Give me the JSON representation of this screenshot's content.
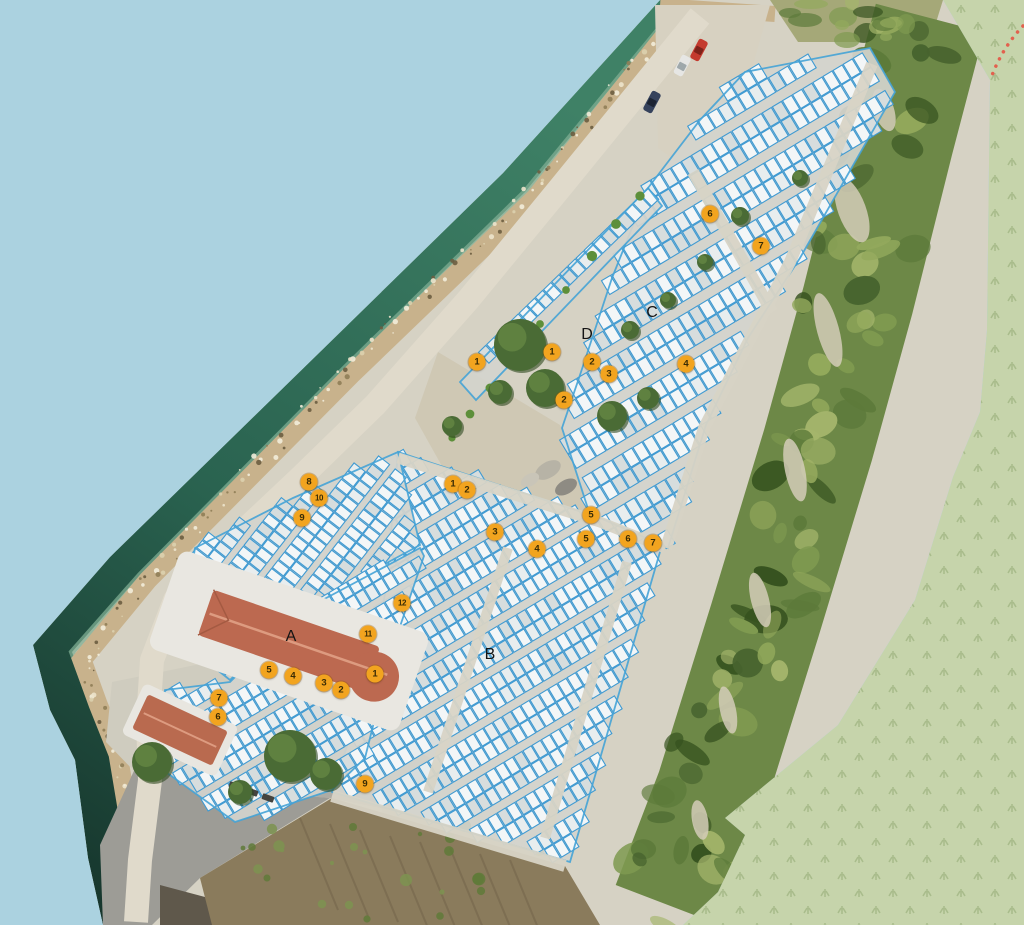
{
  "map": {
    "description": "aerial-orthophoto-berth-map",
    "zone_letters_visible": [
      "A",
      "B",
      "C",
      "D"
    ]
  },
  "colors": {
    "sea_flat": "#abd2e0",
    "land_green": "#c6d4ab",
    "grass_glyph": "#a9bc8c",
    "trail_red": "#e2614e",
    "marker_bg": "#f2a41f",
    "marker_text": "#3a2c05",
    "berth_stroke": "#3f9ad2",
    "berth_fill": "#f3f6f7",
    "zone_label_color": "#141414"
  },
  "markers": [
    {
      "label": "6",
      "x": 710,
      "y": 214
    },
    {
      "label": "7",
      "x": 761,
      "y": 246
    },
    {
      "label": "1",
      "x": 477,
      "y": 362
    },
    {
      "label": "1",
      "x": 552,
      "y": 352
    },
    {
      "label": "2",
      "x": 592,
      "y": 362
    },
    {
      "label": "3",
      "x": 609,
      "y": 374
    },
    {
      "label": "2",
      "x": 564,
      "y": 400
    },
    {
      "label": "4",
      "x": 686,
      "y": 364
    },
    {
      "label": "1",
      "x": 453,
      "y": 484
    },
    {
      "label": "2",
      "x": 467,
      "y": 490
    },
    {
      "label": "3",
      "x": 495,
      "y": 532
    },
    {
      "label": "4",
      "x": 537,
      "y": 549
    },
    {
      "label": "5",
      "x": 591,
      "y": 515
    },
    {
      "label": "5",
      "x": 586,
      "y": 539
    },
    {
      "label": "6",
      "x": 628,
      "y": 539
    },
    {
      "label": "7",
      "x": 653,
      "y": 543
    },
    {
      "label": "8",
      "x": 309,
      "y": 482
    },
    {
      "label": "10",
      "x": 319,
      "y": 498
    },
    {
      "label": "9",
      "x": 302,
      "y": 518
    },
    {
      "label": "12",
      "x": 402,
      "y": 603
    },
    {
      "label": "11",
      "x": 368,
      "y": 634
    },
    {
      "label": "1",
      "x": 375,
      "y": 674
    },
    {
      "label": "2",
      "x": 341,
      "y": 690
    },
    {
      "label": "3",
      "x": 324,
      "y": 683
    },
    {
      "label": "4",
      "x": 293,
      "y": 676
    },
    {
      "label": "5",
      "x": 269,
      "y": 670
    },
    {
      "label": "7",
      "x": 219,
      "y": 698
    },
    {
      "label": "6",
      "x": 218,
      "y": 717
    },
    {
      "label": "9",
      "x": 365,
      "y": 784
    }
  ],
  "zone_labels": [
    {
      "label": "A",
      "x": 291,
      "y": 637
    },
    {
      "label": "B",
      "x": 490,
      "y": 655
    },
    {
      "label": "C",
      "x": 652,
      "y": 313
    },
    {
      "label": "D",
      "x": 587,
      "y": 335
    }
  ]
}
